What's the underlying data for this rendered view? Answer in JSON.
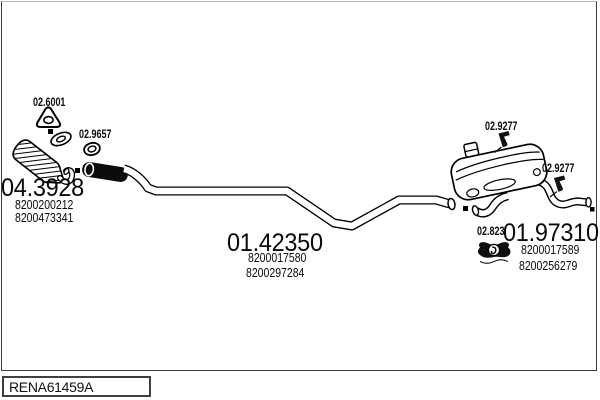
{
  "colors": {
    "background": "#ffffff",
    "line": "#000000",
    "frame": "#3c3c3c"
  },
  "icons": {
    "triangle_gasket": "triangle-gasket-icon",
    "ring_gasket": "ring-gasket-icon",
    "hanger_bracket": "hanger-bracket-icon",
    "rubber_mount": "rubber-mount-icon",
    "connection_marker": "black-square-marker"
  },
  "parts": {
    "gasket_front": {
      "code": "02.6001"
    },
    "gasket_flex": {
      "code": "02.9657"
    },
    "catalyst": {
      "code": "04.3928",
      "ref1": "8200200212",
      "ref2": "8200473341"
    },
    "centre_pipe": {
      "code": "01.42350",
      "ref1": "8200017580",
      "ref2": "8200297284"
    },
    "bracket_front": {
      "code": "02.9277"
    },
    "bracket_rear": {
      "code": "02.9277"
    },
    "rubber_mount": {
      "code": "02.823"
    },
    "rear_silencer": {
      "code": "01.97310",
      "ref1": "8200017589",
      "ref2": "8200256279"
    }
  },
  "footer": {
    "code": "RENA61459A"
  }
}
